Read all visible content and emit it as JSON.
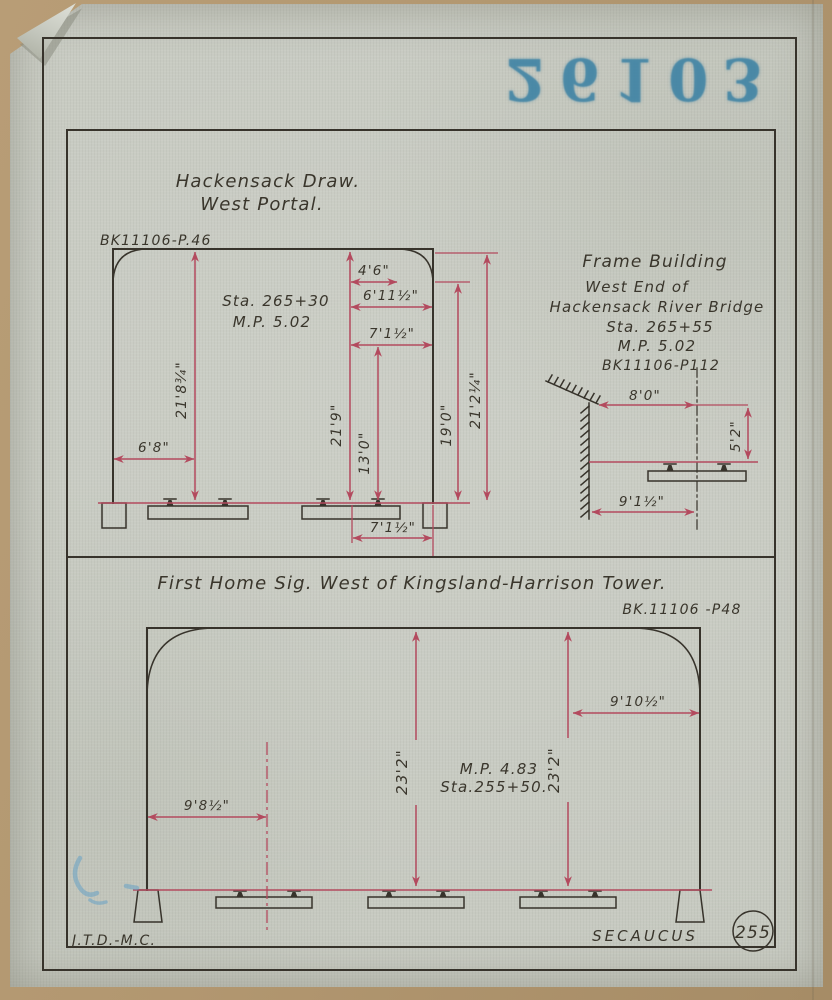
{
  "stamp": {
    "number": "26103",
    "color": "#3a80a3"
  },
  "colors": {
    "paper": "#c6c9c0",
    "backing_tan": "#b29770",
    "ink_black": "#37332b",
    "dimension_red": "#b34a5e",
    "stamp_blue": "#3a80a3"
  },
  "west_portal": {
    "title_line1": "Hackensack Draw.",
    "title_line2": "West Portal.",
    "book_ref": "BK11106-P.46",
    "station": "Sta. 265+30",
    "milepost": "M.P. 5.02",
    "dim_left_height": "21'8¾\"",
    "dim_left_offset": "6'8\"",
    "dim_center_height": "21'9\"",
    "dim_gauge_height": "13'0\"",
    "dim_top_a": "4'6\"",
    "dim_top_b": "6'11½\"",
    "dim_top_c": "7'1½\"",
    "dim_right_inner": "19'0\"",
    "dim_right_outer": "21'2¼\"",
    "dim_bottom": "7'1½\""
  },
  "frame_building": {
    "title": "Frame Building",
    "line2": "West End of",
    "line3": "Hackensack River Bridge",
    "station": "Sta. 265+55",
    "milepost": "M.P. 5.02",
    "book_ref": "BK11106-P112",
    "dim_eave": "8'0\"",
    "dim_height": "5'2\"",
    "dim_base": "9'1½\""
  },
  "home_signal": {
    "title": "First Home Sig. West of Kingsland-Harrison Tower.",
    "book_ref": "BK.11106 -P48",
    "milepost": "M.P. 4.83",
    "station": "Sta.255+50.",
    "dim_left_offset": "9'8½\"",
    "dim_center_height": "23'2\"",
    "dim_right_height": "23'2\"",
    "dim_right_offset": "9'10½\""
  },
  "footer": {
    "drafter": "J.T.D.-M.C.",
    "location": "SECAUCUS",
    "sheet_number": "255"
  }
}
